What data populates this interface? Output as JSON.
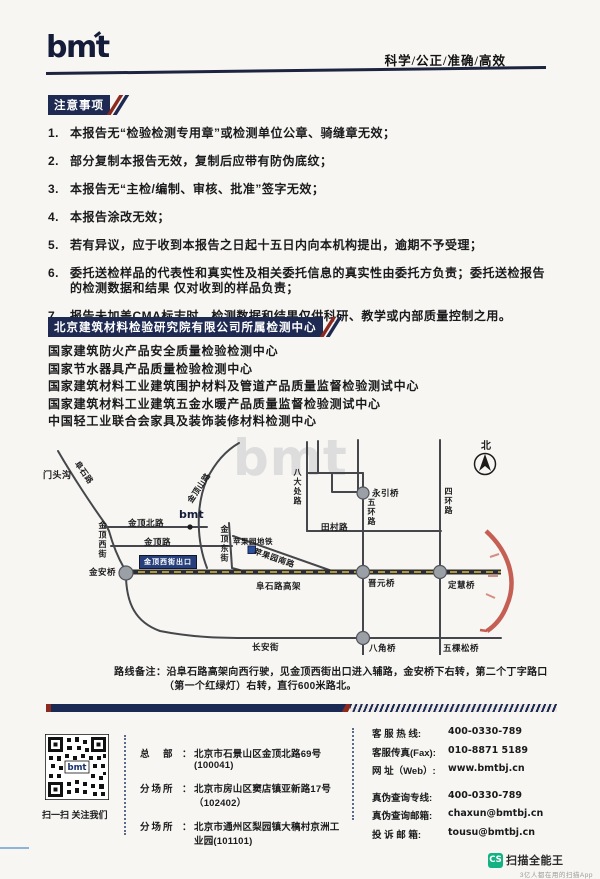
{
  "header": {
    "logo": "bmt",
    "slogan": "科学/公正/准确/高效"
  },
  "notice": {
    "title": "注意事项",
    "items": [
      {
        "num": "1.",
        "text": "本报告无“检验检测专用章”或检测单位公章、骑缝章无效；"
      },
      {
        "num": "2.",
        "text": "部分复制本报告无效，复制后应带有防伪底纹；"
      },
      {
        "num": "3.",
        "text": "本报告无“主检/编制、审核、批准”签字无效；"
      },
      {
        "num": "4.",
        "text": "本报告涂改无效；"
      },
      {
        "num": "5.",
        "text": "若有异议，应于收到本报告之日起十五日内向本机构提出，逾期不予受理；"
      },
      {
        "num": "6.",
        "text": "委托送检样品的代表性和真实性及相关委托信息的真实性由委托方负责；委托送检报告的检测数据和结果 仅对收到的样品负责；"
      },
      {
        "num": "7.",
        "text": "报告未加盖CMA标志时，检测数据和结果仅供科研、教学或内部质量控制之用。"
      }
    ]
  },
  "centers": {
    "title": "北京建筑材料检验研究院有限公司所属检测中心",
    "items": [
      "国家建筑防火产品安全质量检验检测中心",
      "国家节水器具产品质量检验检测中心",
      "国家建筑材料工业建筑围护材料及管道产品质量监督检验测试中心",
      "国家建筑材料工业建筑五金水暖产品质量监督检验测试中心",
      "中国轻工业联合会家具及装饰装修材料检测中心"
    ]
  },
  "map": {
    "labels": {
      "watermark": "bmt",
      "mentougou": "门头沟",
      "fushilu": "阜石路",
      "jindingshanlu": "金顶山路",
      "jindingbeilu": "金顶北路",
      "bmt_marker": "bmt",
      "jindinglu": "金顶路",
      "jindingxijie": "金顶西街",
      "jindingdongjie": "金顶东街",
      "badachulu": "八大处路",
      "pingguoyuan_metro": "苹果园地铁",
      "pingguoyuannanlu": "苹果园南路",
      "tiancunlu": "田村路",
      "wuhuanlu": "五环路",
      "sihuanlu": "四环路",
      "yongyinqiao": "永引桥",
      "north": "北",
      "jinanqiao": "金安桥",
      "exit_badge": "金顶西街出口",
      "fushilugaojia": "阜石路高架",
      "jinyuanqiao": "晋元桥",
      "dinghuiqiao": "定慧桥",
      "changanjie": "长安街",
      "bajiaoqiao": "八角桥",
      "wukesongqiao": "五棵松桥"
    }
  },
  "route_note": {
    "label": "路线备注：",
    "text": "沿阜石路高架向西行驶，见金顶西街出口进入辅路，金安桥下右转，第二个丁字路口（第一个红绿灯）右转，直行600米路北。"
  },
  "footer": {
    "qr_center": "bmt",
    "qr_caption": "扫一扫 关注我们",
    "addresses": [
      {
        "label": "总　部",
        "colon": "：",
        "value": "北京市石景山区金顶北路69号(100041)"
      },
      {
        "label": "分场所",
        "colon": "：",
        "value": "北京市房山区窦店镇亚新路17号（102402）"
      },
      {
        "label": "分场所",
        "colon": "：",
        "value": "北京市通州区梨园镇大稿村京洲工业园(101101)"
      }
    ],
    "contacts_primary": [
      {
        "label": "客 服 热 线:",
        "value": "400-0330-789"
      },
      {
        "label": "客服传真(Fax):",
        "value": "010-8871 5189"
      },
      {
        "label": "网 址（Web）:",
        "value": "www.bmtbj.cn"
      }
    ],
    "contacts_secondary": [
      {
        "label": "真伪查询专线:",
        "value": "400-0330-789"
      },
      {
        "label": "真伪查询邮箱:",
        "value": "chaxun@bmtbj.cn"
      },
      {
        "label": "投 诉 邮 箱:",
        "value": "tousu@bmtbj.cn"
      }
    ]
  },
  "scanner_watermark": {
    "badge": "CS",
    "name": "扫描全能王",
    "subtitle": "3亿人都在用的扫描App"
  }
}
